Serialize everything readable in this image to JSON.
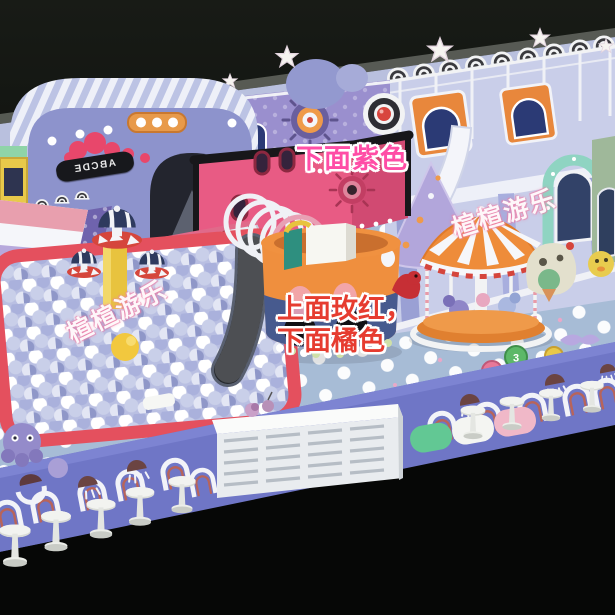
{
  "annotations": {
    "purple_note": {
      "text": "下面紫色",
      "color": "#ff4da6"
    },
    "rose_note": {
      "line1": "上面玫红，",
      "line2": "下面橘色",
      "color": "#e63c30"
    }
  },
  "watermarks": {
    "left": "楦楦游乐",
    "right": "楦楦游乐"
  },
  "arch_banner": {
    "text": "ABCDE"
  },
  "floor_discs": {
    "green": "3",
    "pink": "4"
  },
  "palette": {
    "background_black": "#0b0d0b",
    "floor_blue": "#a7bcd6",
    "floor_dot_white": "#ffffff",
    "apron_periwinkle": "#6f76c6",
    "ballpit_border_red": "#e4505e",
    "ball_lavender": "#c3c8e6",
    "bucket_top_orange": "#f09140",
    "bucket_bottom_navy": "#475a8e",
    "playhouse_rose": "#e85b84",
    "canopy_lavender": "#9299cf",
    "carousel_orange": "#ee8c3a",
    "slide_white": "#f4f5fa",
    "mint_green": "#8fd4c2"
  }
}
